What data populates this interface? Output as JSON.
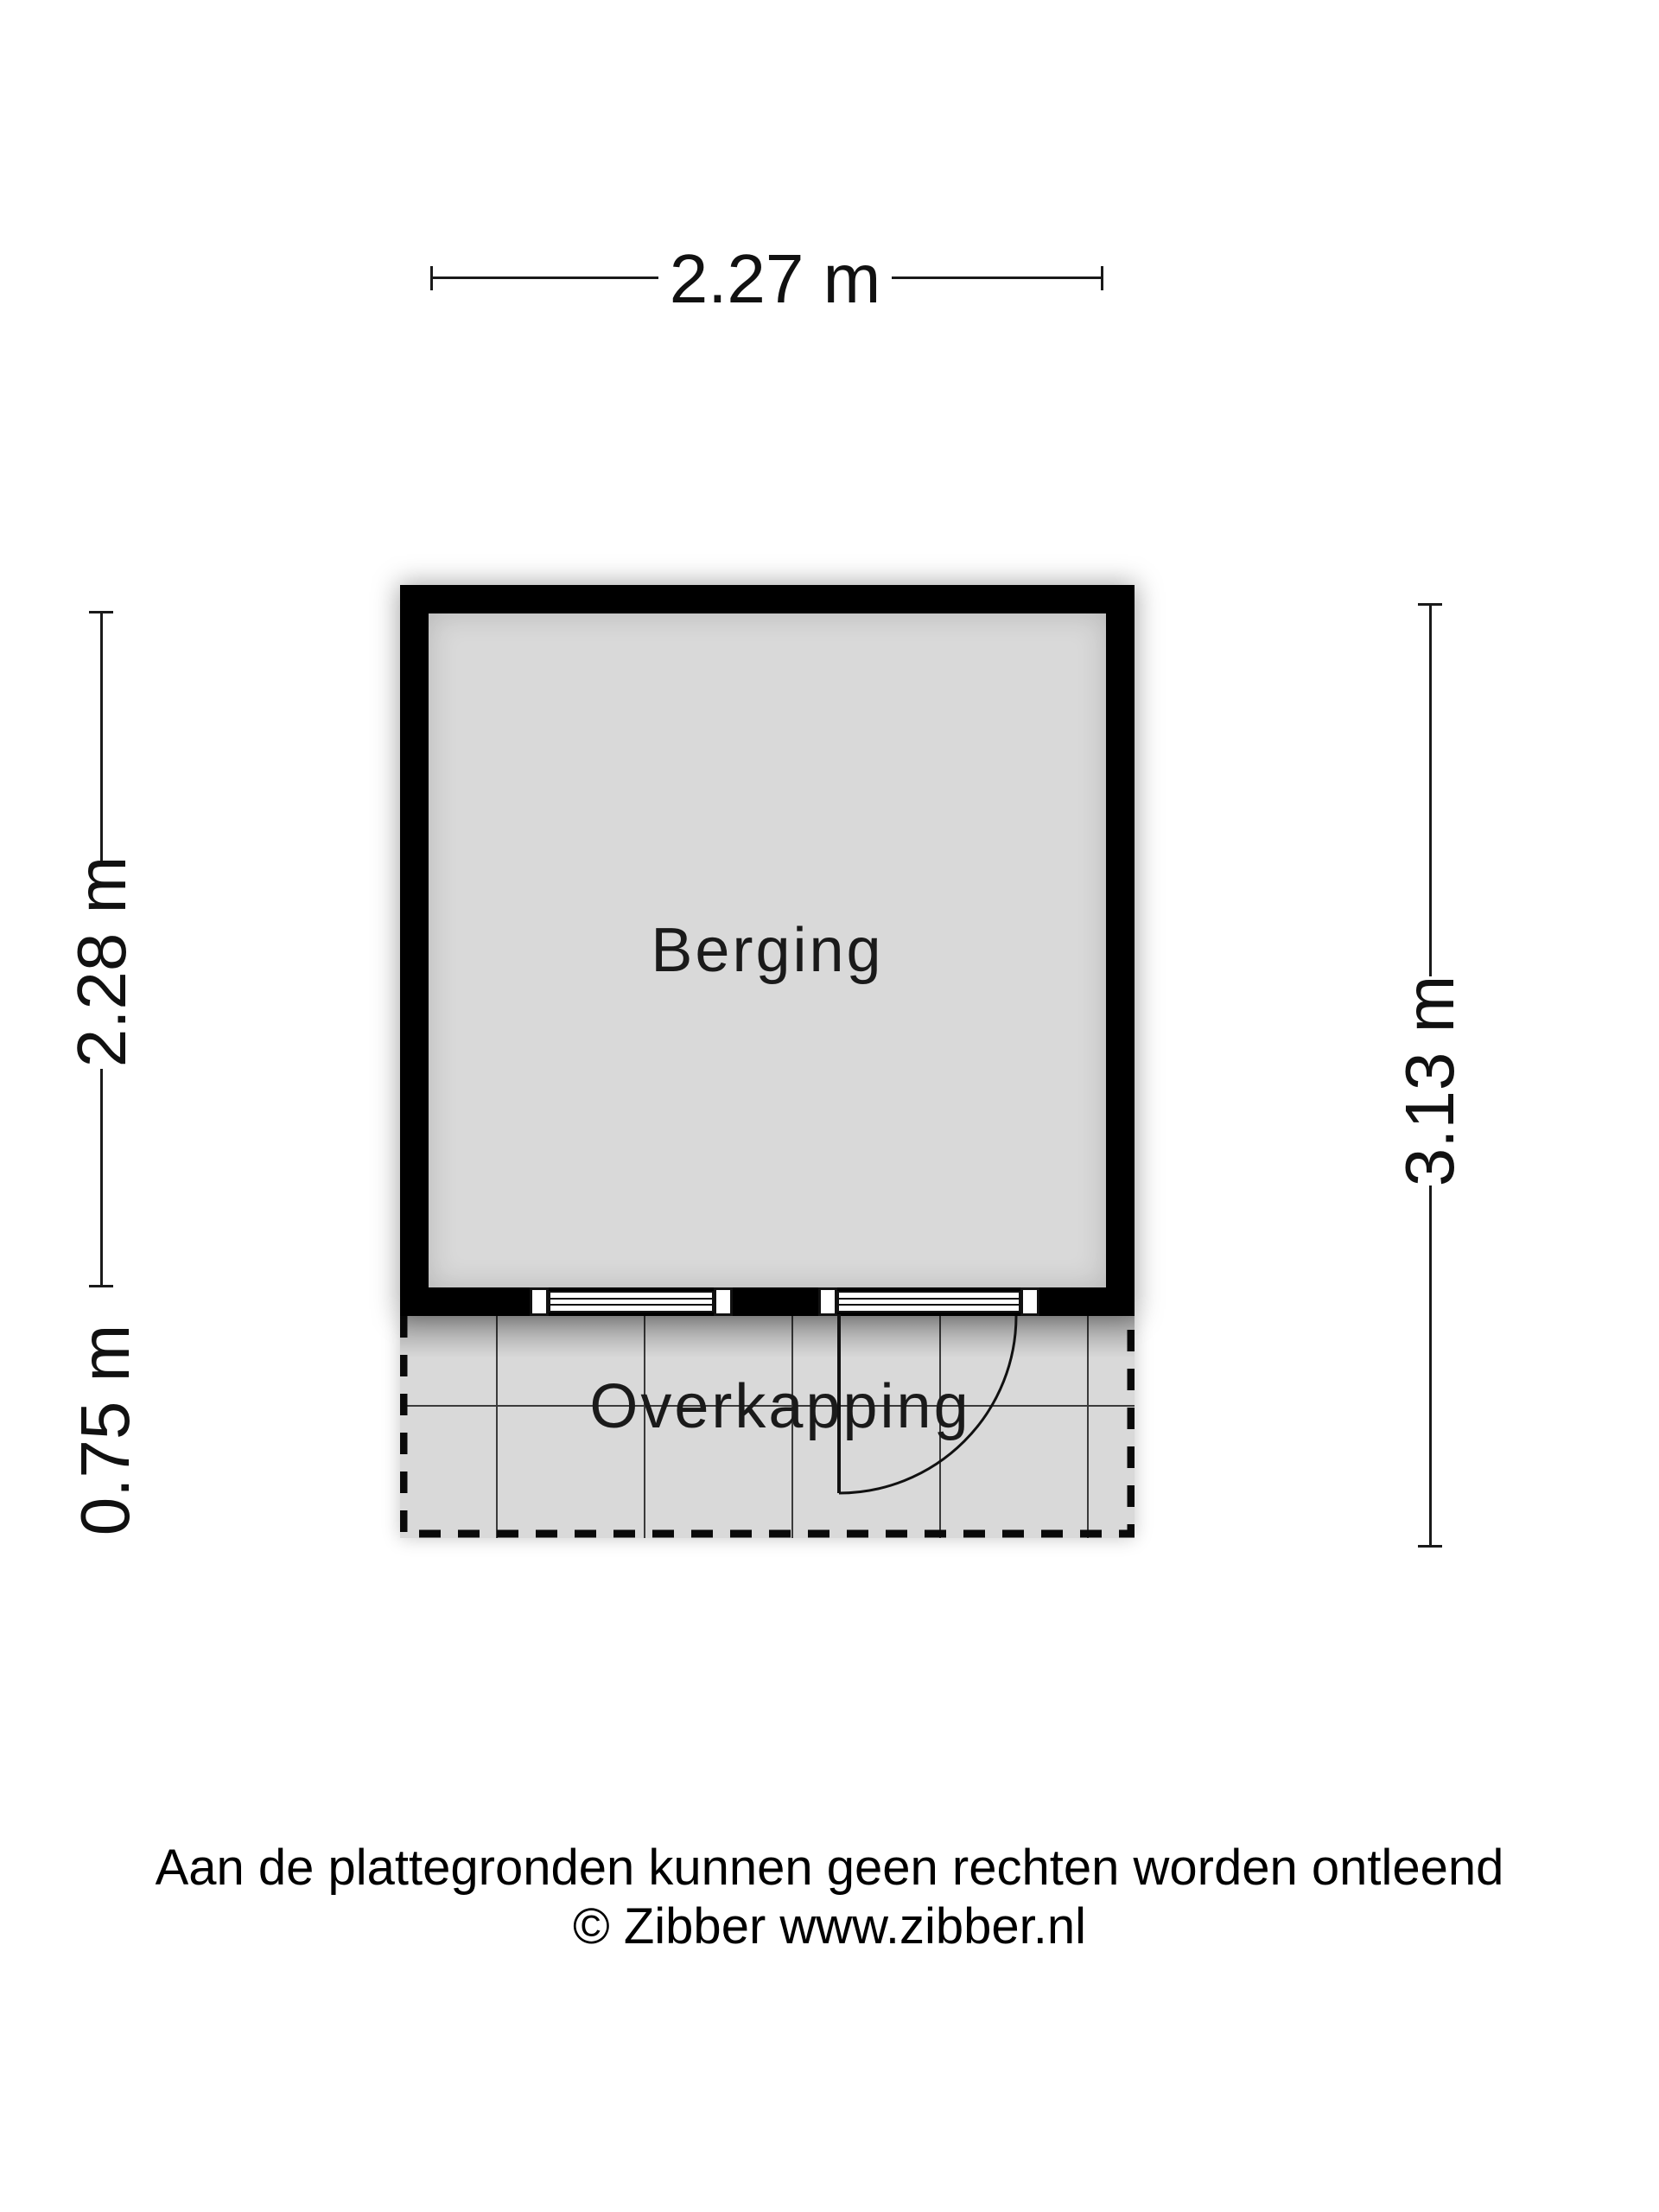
{
  "floorplan": {
    "rooms": {
      "berging": {
        "label": "Berging"
      },
      "overkapping": {
        "label": "Overkapping"
      }
    },
    "dimensions": {
      "top_width": {
        "label": "2.27 m"
      },
      "left_room_height": {
        "label": "2.28 m"
      },
      "left_overhang_depth": {
        "label": "0.75 m"
      },
      "right_total_height": {
        "label": "3.13 m"
      }
    },
    "colors": {
      "wall": "#000000",
      "floor_fill": "#d9d9d9",
      "line": "#1a1a1a",
      "background": "#ffffff"
    }
  },
  "footer": {
    "disclaimer": "Aan de plattegronden kunnen geen rechten worden ontleend",
    "credit": "© Zibber www.zibber.nl"
  }
}
